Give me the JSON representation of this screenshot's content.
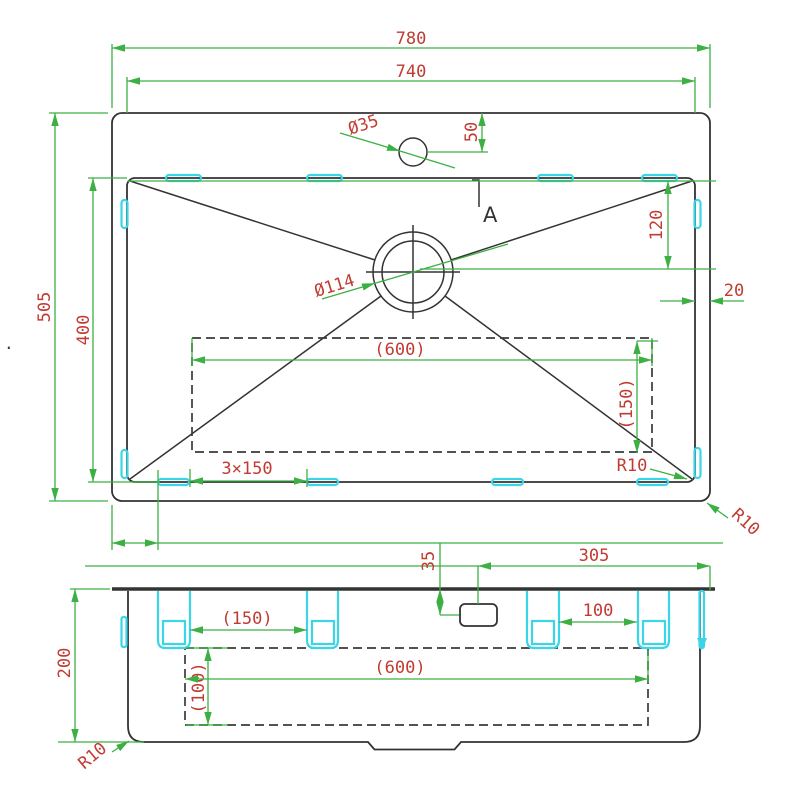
{
  "colors": {
    "dimension_line": "#3CB043",
    "dimension_text": "#C13B32",
    "mounting_clip": "#3AD6E8",
    "outline": "#333333"
  },
  "top_view": {
    "overall_width": "780",
    "bowl_width": "740",
    "overall_depth": "505",
    "bowl_depth": "400",
    "faucet_hole_dia": "Ø35",
    "faucet_hole_offset": "50",
    "drain_dia": "Ø114",
    "drain_offset": "120",
    "rim_gap": "20",
    "cutout_width": "(600)",
    "cutout_depth": "(150)",
    "clip_pitch": "3×150",
    "bowl_corner_radius": "R10",
    "outer_corner_radius": "R10",
    "section_label": "A"
  },
  "section_view": {
    "height": "200",
    "corner_radius": "R10",
    "clip_span_left": "(150)",
    "clip_span_right": "100",
    "cutout_width": "(600)",
    "cutout_depth": "(100)",
    "faucet_offset_from_right": "305",
    "faucet_drop": "35"
  },
  "stray_mark": "."
}
